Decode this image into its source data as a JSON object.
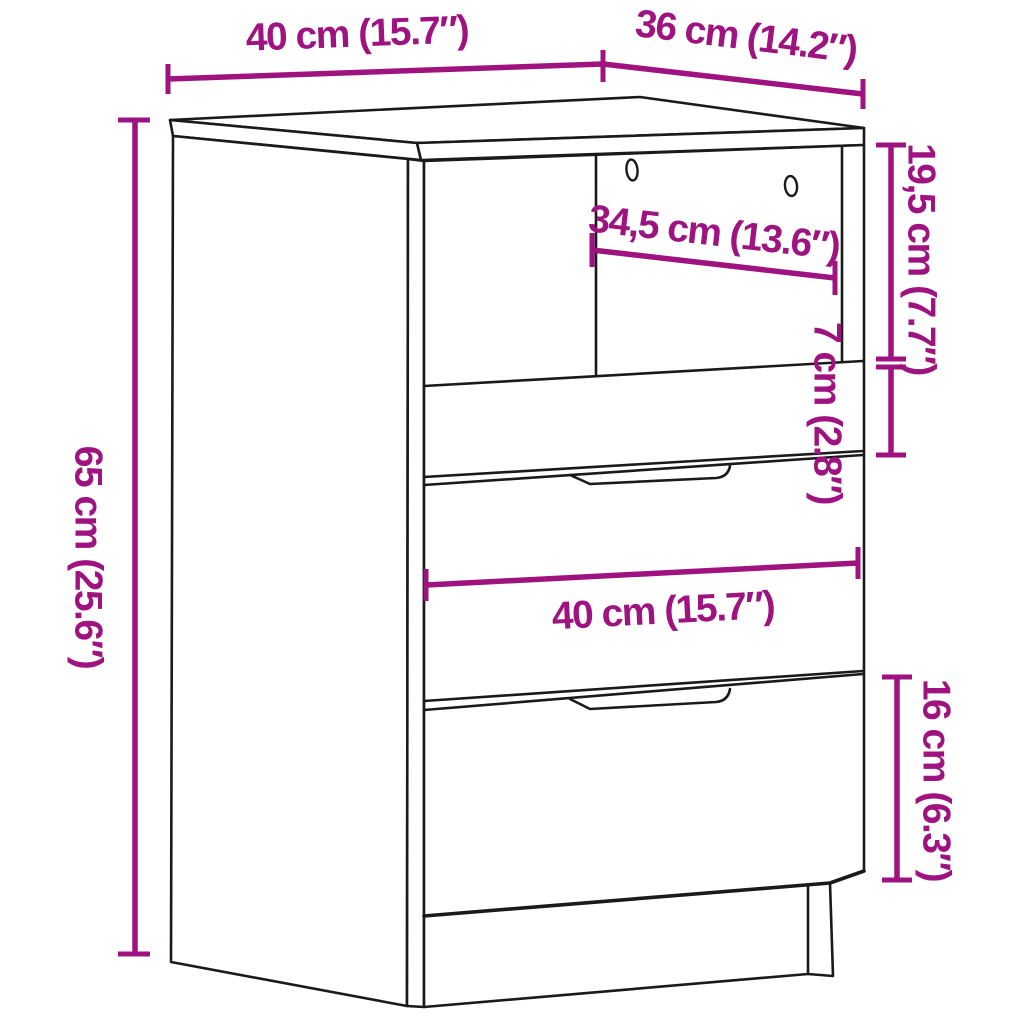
{
  "diagram": {
    "kind": "furniture-dimension-diagram",
    "subject": "bedside-cabinet-with-open-shelf-and-three-drawers"
  },
  "colors": {
    "dimension_accent": "#9e1380",
    "outline": "#1a1a1a",
    "background": "#ffffff"
  },
  "dimensions": {
    "top_width": "40 cm (15.7″)",
    "top_depth": "36 cm (14.2″)",
    "overall_height": "65 cm (25.6″)",
    "inner_width": "34,5 cm (13.6″)",
    "open_section_height": "19,5 cm (7.7″)",
    "small_drawer_height": "7 cm (2.8″)",
    "drawer_width": "40 cm (15.7″)",
    "bottom_drawer_height": "16 cm (6.3″)"
  }
}
